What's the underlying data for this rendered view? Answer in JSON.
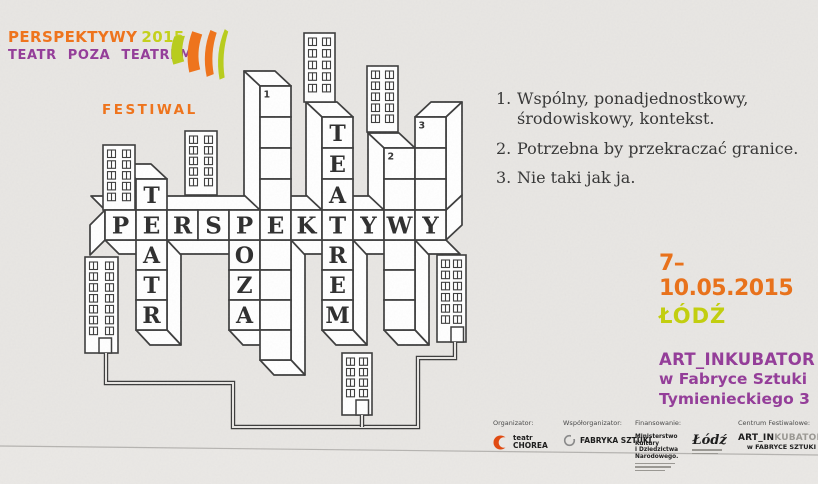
{
  "colors": {
    "paper": "#e8e6e3",
    "paper_below_fold": "#eae8e5",
    "ink": "#3c3c3c",
    "letter": "#2d2d2d",
    "orange": "#ee741d",
    "lime": "#c4d01e",
    "purple": "#943e99",
    "city_lime": "#c2ce10",
    "chorea_red": "#e04b12"
  },
  "header": {
    "title_word": "PERSPEKTYWY",
    "title_year": "2015",
    "subtitle": "TEATR POZA TEATREM",
    "festival_label": "FESTIWAL"
  },
  "clues": [
    {
      "number": "1.",
      "text": "Wspólny, ponadjednostkowy, środowiskowy, kontekst."
    },
    {
      "number": "2.",
      "text": "Potrzebna by przekraczać granice."
    },
    {
      "number": "3.",
      "text": "Nie taki jak ja."
    }
  ],
  "event": {
    "dates": "7–10.05.2015",
    "city": "ŁÓDŹ",
    "venue_name": "ART_INKUBATOR",
    "venue_line2": "w Fabryce Sztuki",
    "venue_line3": "Tymienieckiego 3"
  },
  "crossword": {
    "across_answer": "PERSPEKTYWY",
    "down": [
      {
        "name": "TEATR",
        "col": 2,
        "above": [
          "T"
        ],
        "below": [
          "A",
          "T",
          "R"
        ]
      },
      {
        "name": "POZA",
        "col": 5,
        "above": [],
        "below": [
          "O",
          "Z",
          "A"
        ]
      },
      {
        "name": "slot-1",
        "number": "1",
        "col": 6,
        "above": [
          "",
          "",
          "",
          ""
        ],
        "below": [
          "",
          "",
          "",
          ""
        ]
      },
      {
        "name": "TEATREM",
        "col": 8,
        "above": [
          "T",
          "E",
          "A"
        ],
        "below": [
          "R",
          "E",
          "M"
        ]
      },
      {
        "name": "slot-2",
        "number": "2",
        "col": 10,
        "above": [
          "",
          ""
        ],
        "below": [
          "",
          "",
          ""
        ]
      },
      {
        "name": "slot-3",
        "number": "3",
        "col": 11,
        "above": [
          "",
          "",
          ""
        ],
        "below": []
      }
    ]
  },
  "buildings": [
    {
      "x": 304,
      "y": 33,
      "w": 31,
      "h": 69,
      "rows": 5
    },
    {
      "x": 367,
      "y": 66,
      "w": 31,
      "h": 66,
      "rows": 5
    },
    {
      "x": 103,
      "y": 145,
      "w": 32,
      "h": 65,
      "rows": 5
    },
    {
      "x": 185,
      "y": 131,
      "w": 32,
      "h": 64,
      "rows": 5
    },
    {
      "x": 85,
      "y": 257,
      "w": 33,
      "h": 96,
      "rows": 7,
      "door": true
    },
    {
      "x": 437,
      "y": 255,
      "w": 29,
      "h": 87,
      "rows": 6,
      "door": true
    },
    {
      "x": 342,
      "y": 353,
      "w": 30,
      "h": 62,
      "rows": 4,
      "door": true
    }
  ],
  "footer": {
    "columns": [
      {
        "label": "Organizator:",
        "logo_lines": [
          "teatr",
          "CHOREA"
        ]
      },
      {
        "label": "Współorganizator:",
        "logo_lines": [
          "FABRYKA SZTUKI"
        ]
      },
      {
        "label": "Finansowanie:",
        "logo_lines": [
          "Ministerstwo",
          "Kultury",
          "i Dziedzictwa",
          "Narodowego."
        ],
        "logo2": "Łódź"
      },
      {
        "label": "Centrum Festiwalowe:",
        "logo_lines": [
          "ART_IN",
          "KUBATOR",
          "w FABRYCE SZTUKI"
        ]
      }
    ]
  }
}
